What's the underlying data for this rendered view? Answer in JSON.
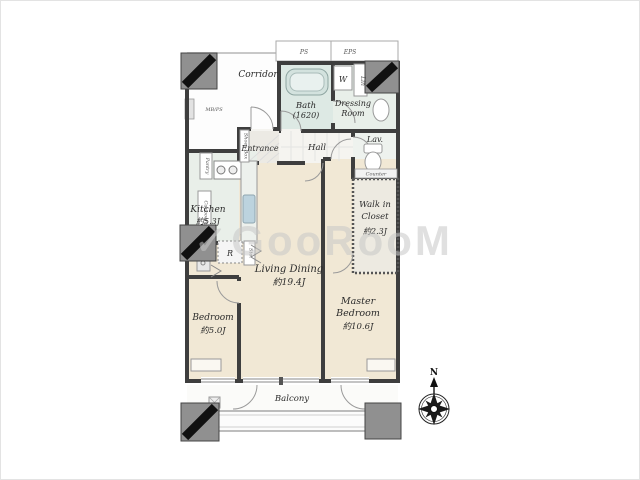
{
  "floorplan": {
    "watermark": "✓GooRooM",
    "compass": {
      "north": "N"
    },
    "common": {
      "corridor": "Corridor",
      "ps": "PS",
      "eps": "EPS",
      "mbps": "MB/PS"
    },
    "rooms": {
      "entrance": "Entrance",
      "hall": "Hall",
      "bath": {
        "name": "Bath",
        "size": "(1620)"
      },
      "washer": "W",
      "linen": "Lin",
      "dressing": {
        "line1": "Dressing",
        "line2": "Room"
      },
      "lavatory": "Lav.",
      "counter": "Counter",
      "kitchen": {
        "name": "Kitchen",
        "area": "約5.3J"
      },
      "living": {
        "name": "Living Dining",
        "area": "約19.4J"
      },
      "bedroom": {
        "name": "Bedroom",
        "area": "約5.0J"
      },
      "master": {
        "line1": "Master",
        "line2": "Bedroom",
        "area": "約10.6J"
      },
      "wic": {
        "line1": "Walk in",
        "line2": "Closet",
        "area": "約2.3J"
      },
      "balcony": "Balcony"
    },
    "fixtures": {
      "refrigerator": "R",
      "storage": "Sto.",
      "pantry": "Pantry",
      "cupboard": "Cupboard",
      "shoes_box": "Shoes Box"
    }
  }
}
